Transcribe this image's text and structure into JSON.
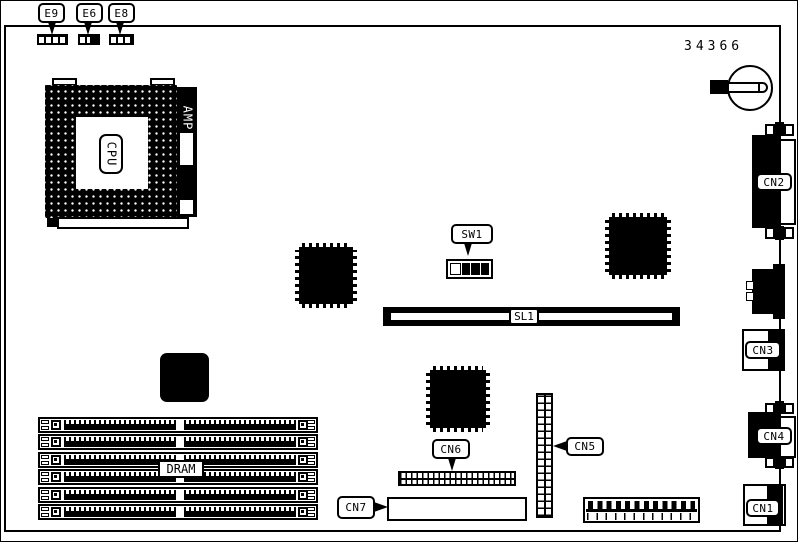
{
  "colors": {
    "ink": "#000000",
    "paper": "#ffffff"
  },
  "part_number": "34366",
  "jumpers": {
    "e9": "E9",
    "e6": "E6",
    "e8": "E8"
  },
  "cpu": {
    "socket": "CPU",
    "bracket": "AMP"
  },
  "switch_label": "SW1",
  "riser_label": "SL1",
  "memory_label": "DRAM",
  "connectors": {
    "cn1": "CN1",
    "cn2": "CN2",
    "cn3": "CN3",
    "cn4": "CN4",
    "cn5": "CN5",
    "cn6": "CN6",
    "cn7": "CN7"
  }
}
